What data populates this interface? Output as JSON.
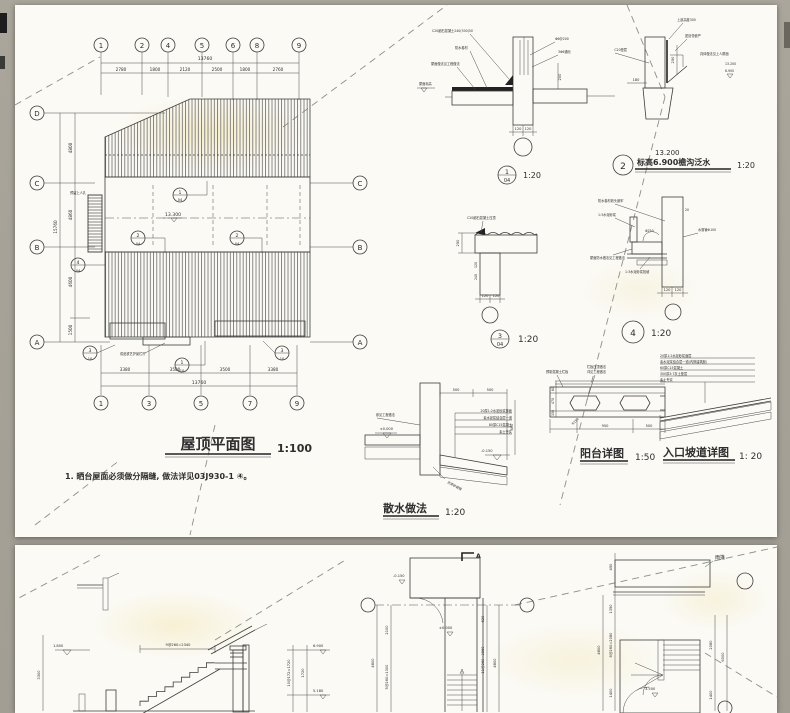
{
  "colors": {
    "background": "#a7a399",
    "sheet": "#fbfaf5",
    "line": "#3c3c3c",
    "crease": "#8e8e8a"
  },
  "roof_plan": {
    "title": "屋顶平面图",
    "scale": "1:100",
    "note": "1. 晒台屋面必须做分隔缝, 做法详见03J930-1 ④。",
    "top_axes": [
      "1",
      "2",
      "4",
      "5",
      "6",
      "8",
      "9"
    ],
    "top_dims": [
      "2780",
      "1800",
      "2120",
      "2500",
      "1800",
      "2760"
    ],
    "top_total": "13760",
    "left_axes": [
      "D",
      "C",
      "B",
      "A"
    ],
    "left_dims": [
      "4800",
      "4860",
      "4600",
      "1500"
    ],
    "left_total": "15760",
    "right_axes": [
      "C",
      "B",
      "A"
    ],
    "bottom_axes": [
      "1",
      "3",
      "5",
      "7",
      "9"
    ],
    "bottom_dims": [
      "3380",
      "3500",
      "3500",
      "3380"
    ],
    "bottom_total": "13760",
    "level": "13.300",
    "label_manhole": "预留上人孔",
    "label_rail": "成品铁艺护窗栏杆",
    "callouts": [
      {
        "n": "1",
        "s": "04"
      },
      {
        "n": "2",
        "s": "04"
      },
      {
        "n": "2",
        "s": "04"
      },
      {
        "n": "4",
        "s": "04"
      },
      {
        "n": "3",
        "s": "10"
      },
      {
        "n": "1",
        "s": "10"
      },
      {
        "n": "3",
        "s": "10"
      }
    ]
  },
  "detail1": {
    "labels": [
      "C20细石混凝土240(300)50",
      "防水卷材",
      "屋面做法见工程做法",
      "屋面标高",
      "Φ6@200",
      "3Φ6通长"
    ],
    "dim_right": "200",
    "dims_bottom": [
      "120",
      "120"
    ],
    "callout_num": "1",
    "callout_sheet": "04",
    "scale": "1:20"
  },
  "detail2": {
    "labels": [
      "上返高度300",
      "密封膏嵌严",
      "具体做法见上人屋面",
      "C20垫层"
    ],
    "dim_left": "180",
    "dim_right": "250",
    "levels": [
      "13.200",
      "6.900"
    ],
    "callout_num": "2",
    "title_line1": "13.200",
    "title_line2": "标高6.900檐沟泛水",
    "scale": "1:20"
  },
  "detail3": {
    "label_top": "C20细石混凝土压顶",
    "dim_left": "250",
    "dims_wall": [
      "120",
      "240"
    ],
    "dims_bottom": [
      "120",
      "120"
    ],
    "callout_num": "3",
    "callout_sheet": "04",
    "scale": "1:20"
  },
  "detail4": {
    "labels": [
      "防水卷材收头嵌牢",
      "1:3水泥砂浆",
      "屋面防水做法见工程做法",
      "1:3水泥砂浆找坡",
      "水落管Φ100",
      "20"
    ],
    "drain": "Φ250",
    "dims_bottom": [
      "120",
      "120"
    ],
    "callout_num": "4",
    "scale": "1:20"
  },
  "sanshui": {
    "title": "散水做法",
    "scale": "1:20",
    "dims_top": [
      "500",
      "500"
    ],
    "dim_right": "400",
    "level_right": "-0.150",
    "level_left": "±0.000",
    "label_left": "参见工程做法",
    "layers": [
      "20厚1:2水泥砂浆抹面",
      "素水泥浆结合层一道",
      "80厚C15混凝土",
      "素土夯实"
    ],
    "label_bottom": "沥青砂嵌缝"
  },
  "balcony": {
    "title": "阳台详图",
    "scale": "1:50",
    "labels": [
      "预制混凝土栏板",
      "栏板压顶做法",
      "详见工程做法"
    ],
    "dims_bottom": [
      "950",
      "500"
    ],
    "radius": "R150",
    "side_dims": [
      "60",
      "470",
      "150"
    ]
  },
  "ramp": {
    "title": "入口坡道详图",
    "scale": "1: 20",
    "layers": [
      "20厚1:2水泥砂浆面层",
      "素水泥浆结合层一道(内掺建筑胶)",
      "60厚C15混凝土",
      "300厚3:7灰土垫层",
      "素土夯实"
    ]
  },
  "bottom_sheet": {
    "stair_section": {
      "level": "1.800",
      "dim_top": "9@260=2340",
      "dim_left": "3300"
    },
    "mid_section": {
      "levels": [
        "6.900",
        "5.180"
      ],
      "dims": [
        "10@172=1720",
        "1720"
      ]
    },
    "stair_plan1": {
      "section_mark": "A",
      "level_zero": "±0.000",
      "level_top": "-0.150",
      "dims_left": [
        "2100",
        "5@260=1300"
      ],
      "dim_total_left": "4800",
      "dims_right": [
        "620",
        "11@260=2860"
      ],
      "dim_total_right": "4800"
    },
    "stair_plan2": {
      "canopy_label": "雨篷",
      "level": "3.500",
      "dims_left": [
        "450",
        "1350",
        "8@260=2080",
        "1400"
      ],
      "dim_total_left": "4800",
      "dims_right": [
        "2080",
        "1400"
      ],
      "dim_total_right": "6000"
    }
  }
}
